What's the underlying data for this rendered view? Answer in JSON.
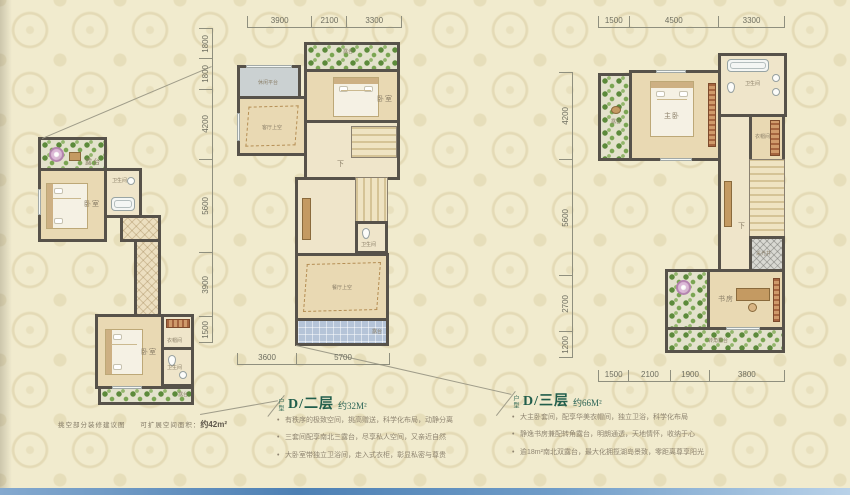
{
  "page": {
    "bg_color": "#f1ebce",
    "wall_color": "#57524a",
    "title_color": "#215e4c",
    "footer_bar_colors": [
      "#84a9cf",
      "#4d80b4",
      "#b9d2e9"
    ]
  },
  "left": {
    "caption_title": "挑空部分装修建议图",
    "caption_label": "可扩展空间面积：",
    "caption_value": "约42m²",
    "rooms": {
      "terrace": "露台",
      "bed1": "卧室",
      "bath1": "卫生间",
      "bed2": "卧室",
      "closet": "衣帽间",
      "bath2": "卫生间",
      "garden": "露台"
    }
  },
  "mid": {
    "unit_prefix": "户型",
    "title": "D/二层",
    "area": "约32M²",
    "dims_top": [
      "3900",
      "2100",
      "3300"
    ],
    "dims_left": [
      "1800",
      "1800",
      "4200",
      "5600",
      "3900",
      "1500"
    ],
    "dims_bottom": [
      "3600",
      "5700"
    ],
    "rooms": {
      "platform": "休闲平台",
      "living_void": "客厅上空",
      "terrace": "露台",
      "bedroom": "卧室",
      "stair": "下",
      "bath": "卫生间",
      "dining_void": "餐厅上空",
      "terrace_b": "露台"
    },
    "bullets": [
      "有秩序的极致空间，挑高赠送，科学化布局，动静分离",
      "三套间配享南北三露台，尽享私人空间，又亲近自然",
      "大卧室带独立卫浴间，走入式衣柜，彰显私密与尊贵"
    ]
  },
  "right": {
    "unit_prefix": "户型",
    "title": "D/三层",
    "area": "约66M²",
    "dims_top": [
      "1500",
      "4500",
      "3300"
    ],
    "dims_left": [
      "4200",
      "5600",
      "2700",
      "1200"
    ],
    "dims_bottom": [
      "1500",
      "2100",
      "1900",
      "3800"
    ],
    "rooms": {
      "terrace": "露台",
      "master": "主卧",
      "bath": "卫生间",
      "closet": "衣帽间",
      "stair": "下",
      "shaft": "采光井",
      "study": "书房",
      "corner_terrace": "转角露台"
    },
    "bullets": [
      "大主卧套间，配享华美衣帽间，独立卫浴，科学化布局",
      "静逸书房兼配转角露台，明朗通透，天地情怀，收纳于心",
      "逾18m²南北双露台，最大化拥揽湖岛景致，零距离尊享阳光"
    ]
  }
}
